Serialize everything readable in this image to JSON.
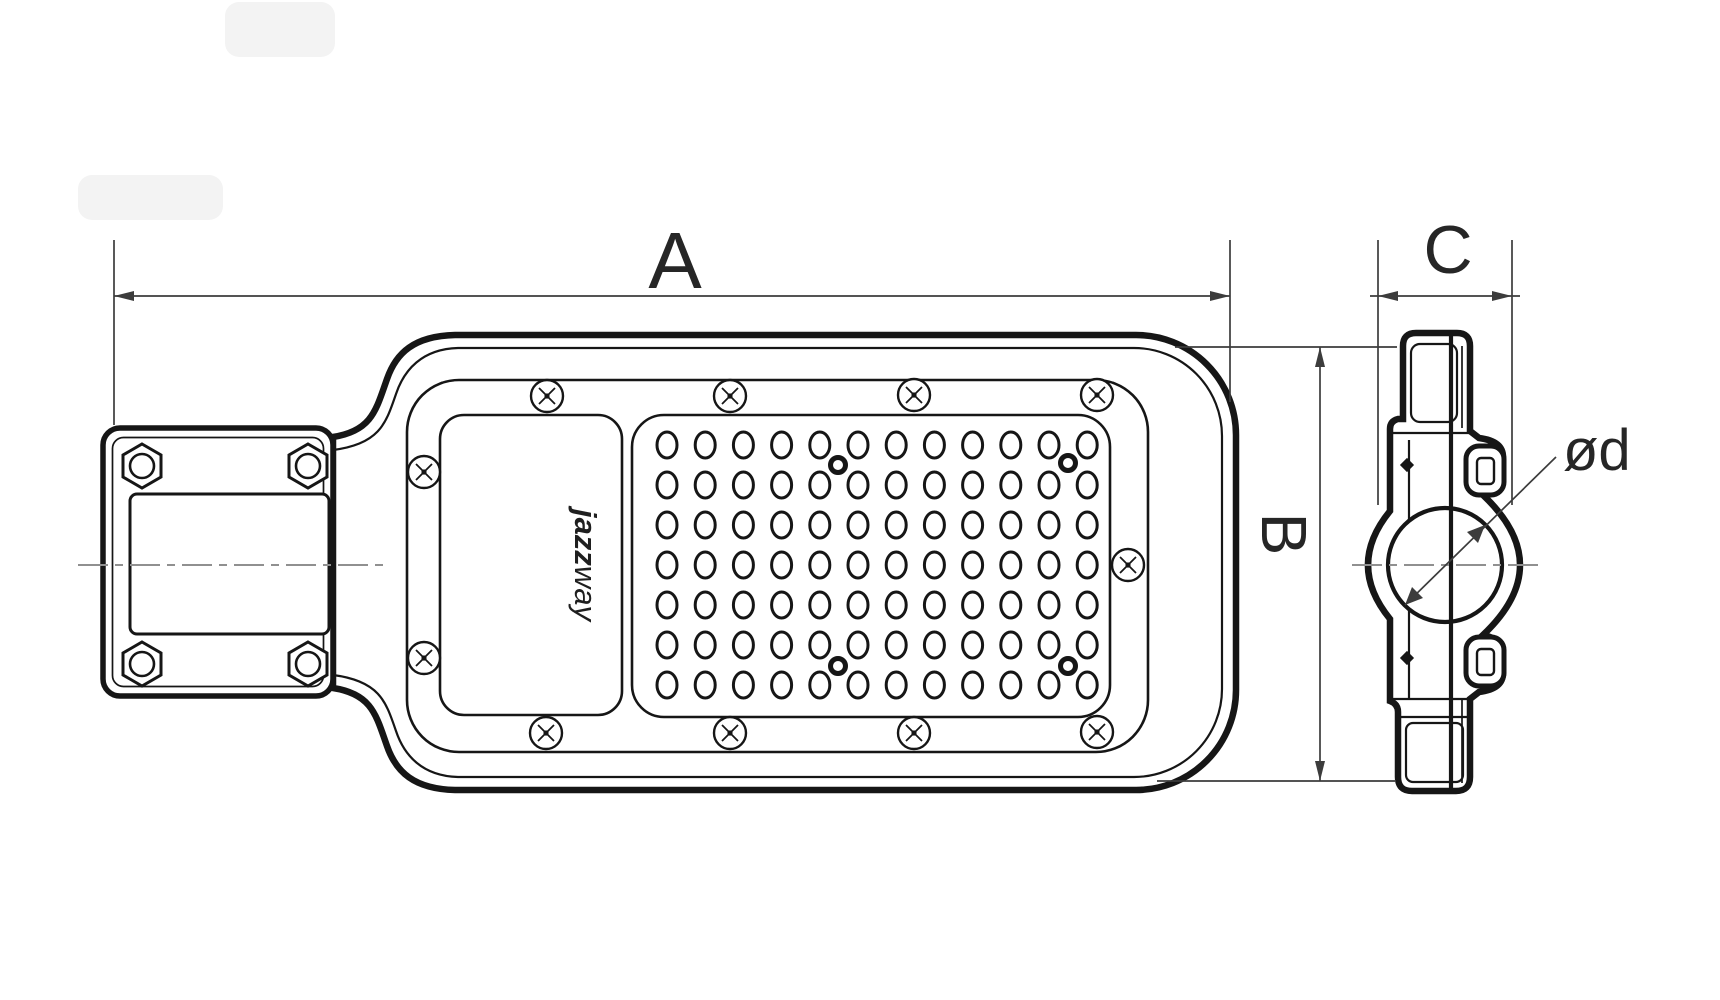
{
  "drawing": {
    "labels": {
      "dim_a": "A",
      "dim_b": "B",
      "dim_c": "C",
      "dim_d": "ød"
    },
    "logo": {
      "bold": "jazz",
      "light": "way"
    },
    "colors": {
      "line": "#161616",
      "dimension": "#3c3c3c",
      "centerline": "#909090",
      "background": "#ffffff"
    },
    "led_grid": {
      "cols": 12,
      "rows": 7,
      "x0": 667,
      "y0": 445,
      "dx": 38.2,
      "dy": 40,
      "rx": 10,
      "ry": 13
    },
    "screws": [
      [
        547,
        396
      ],
      [
        730,
        396
      ],
      [
        914,
        395
      ],
      [
        1097,
        395
      ],
      [
        546,
        733
      ],
      [
        730,
        733
      ],
      [
        914,
        733
      ],
      [
        1097,
        732
      ],
      [
        424,
        472
      ],
      [
        424,
        658
      ],
      [
        1128,
        565
      ]
    ],
    "posts": [
      [
        838,
        465
      ],
      [
        1068,
        463
      ],
      [
        838,
        666
      ],
      [
        1068,
        666
      ]
    ],
    "hex_nuts": [
      [
        142,
        466
      ],
      [
        308,
        466
      ],
      [
        142,
        664
      ],
      [
        308,
        664
      ]
    ]
  }
}
